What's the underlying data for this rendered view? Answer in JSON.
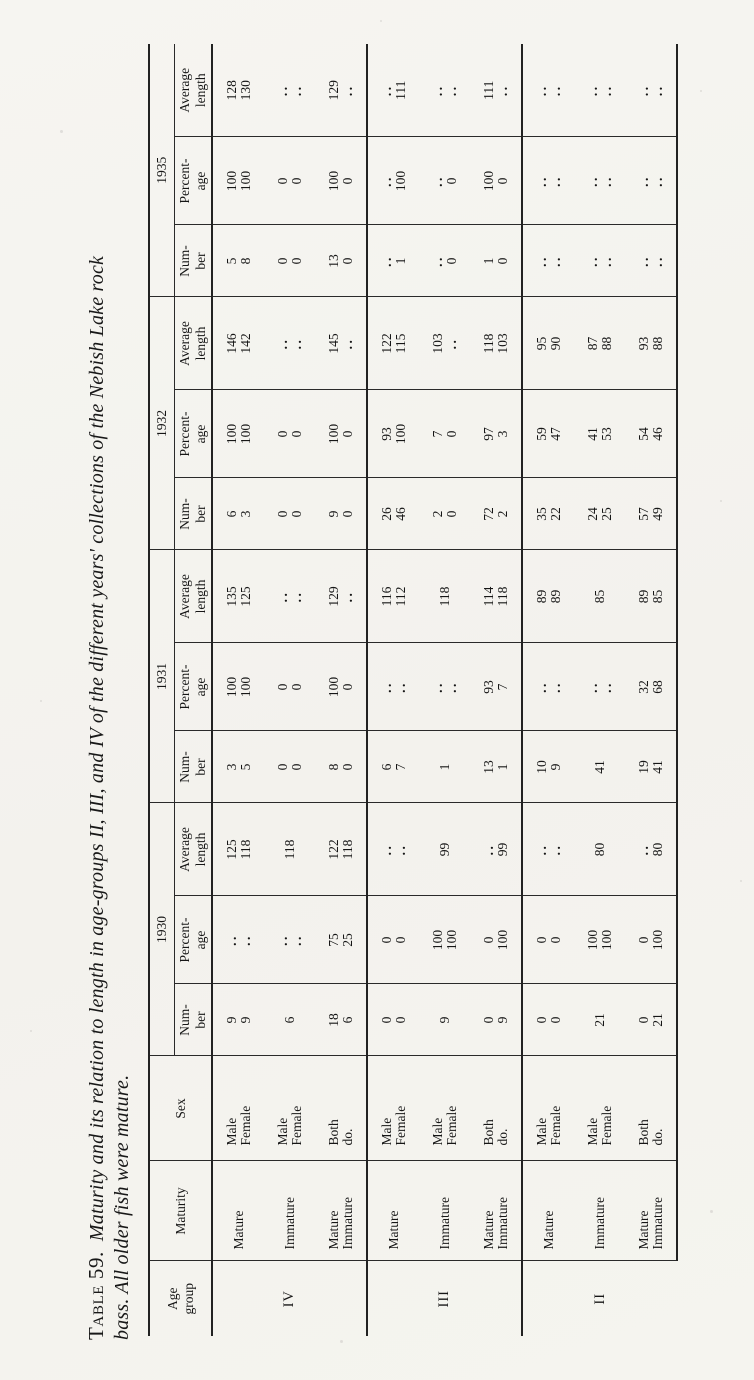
{
  "title": {
    "label": "Table 59.",
    "line1": "Maturity and its relation to length in age-groups II, III, and IV of the different years' collections of the Nebish Lake rock",
    "line2": "bass.  All older fish were mature."
  },
  "table": {
    "headers": {
      "age_group": [
        "Age",
        "group"
      ],
      "maturity": [
        "Maturity"
      ],
      "sex": [
        "Sex"
      ],
      "years": [
        "1930",
        "1931",
        "1932",
        "1935"
      ],
      "year_sub": [
        [
          "Num-",
          "ber"
        ],
        [
          "Percent-",
          "age"
        ],
        [
          "Average",
          "length"
        ]
      ]
    },
    "groups": [
      {
        "age": "IV",
        "blocks": [
          {
            "maturity": [
              "Mature"
            ],
            "sex": [
              "Male",
              "Female"
            ],
            "years": [
              {
                "n": [
                  "9",
                  "9"
                ],
                "p": [
                  "..",
                  ".."
                ],
                "a": [
                  "125",
                  "118"
                ]
              },
              {
                "n": [
                  "3",
                  "5"
                ],
                "p": [
                  "100",
                  "100"
                ],
                "a": [
                  "135",
                  "125"
                ]
              },
              {
                "n": [
                  "6",
                  "3"
                ],
                "p": [
                  "100",
                  "100"
                ],
                "a": [
                  "146",
                  "142"
                ]
              },
              {
                "n": [
                  "5",
                  "8"
                ],
                "p": [
                  "100",
                  "100"
                ],
                "a": [
                  "128",
                  "130"
                ]
              }
            ]
          },
          {
            "maturity": [
              "Immature"
            ],
            "sex": [
              "Male",
              "Female"
            ],
            "years": [
              {
                "n": [
                  "6"
                ],
                "p": [
                  "..",
                  ".."
                ],
                "a": [
                  "118"
                ]
              },
              {
                "n": [
                  "0",
                  "0"
                ],
                "p": [
                  "0",
                  "0"
                ],
                "a": [
                  "..",
                  ".."
                ]
              },
              {
                "n": [
                  "0",
                  "0"
                ],
                "p": [
                  "0",
                  "0"
                ],
                "a": [
                  "..",
                  ".."
                ]
              },
              {
                "n": [
                  "0",
                  "0"
                ],
                "p": [
                  "0",
                  "0"
                ],
                "a": [
                  "..",
                  ".."
                ]
              }
            ]
          },
          {
            "maturity": [
              "Mature",
              "Immature"
            ],
            "sex": [
              "Both",
              "do."
            ],
            "years": [
              {
                "n": [
                  "18",
                  "6"
                ],
                "p": [
                  "75",
                  "25"
                ],
                "a": [
                  "122",
                  "118"
                ]
              },
              {
                "n": [
                  "8",
                  "0"
                ],
                "p": [
                  "100",
                  "0"
                ],
                "a": [
                  "129",
                  ".."
                ]
              },
              {
                "n": [
                  "9",
                  "0"
                ],
                "p": [
                  "100",
                  "0"
                ],
                "a": [
                  "145",
                  ".."
                ]
              },
              {
                "n": [
                  "13",
                  "0"
                ],
                "p": [
                  "100",
                  "0"
                ],
                "a": [
                  "129",
                  ".."
                ]
              }
            ]
          }
        ]
      },
      {
        "age": "III",
        "blocks": [
          {
            "maturity": [
              "Mature"
            ],
            "sex": [
              "Male",
              "Female"
            ],
            "years": [
              {
                "n": [
                  "0",
                  "0"
                ],
                "p": [
                  "0",
                  "0"
                ],
                "a": [
                  "..",
                  ".."
                ]
              },
              {
                "n": [
                  "6",
                  "7"
                ],
                "p": [
                  "..",
                  ".."
                ],
                "a": [
                  "116",
                  "112"
                ]
              },
              {
                "n": [
                  "26",
                  "46"
                ],
                "p": [
                  "93",
                  "100"
                ],
                "a": [
                  "122",
                  "115"
                ]
              },
              {
                "n": [
                  "..",
                  "1"
                ],
                "p": [
                  "..",
                  "100"
                ],
                "a": [
                  "..",
                  "111"
                ]
              }
            ]
          },
          {
            "maturity": [
              "Immature"
            ],
            "sex": [
              "Male",
              "Female"
            ],
            "years": [
              {
                "n": [
                  "9"
                ],
                "p": [
                  "100",
                  "100"
                ],
                "a": [
                  "99"
                ]
              },
              {
                "n": [
                  "1"
                ],
                "p": [
                  "..",
                  ".."
                ],
                "a": [
                  "118"
                ]
              },
              {
                "n": [
                  "2",
                  "0"
                ],
                "p": [
                  "7",
                  "0"
                ],
                "a": [
                  "103",
                  ".."
                ]
              },
              {
                "n": [
                  "..",
                  "0"
                ],
                "p": [
                  "..",
                  "0"
                ],
                "a": [
                  "..",
                  ".."
                ]
              }
            ]
          },
          {
            "maturity": [
              "Mature",
              "Immature"
            ],
            "sex": [
              "Both",
              "do."
            ],
            "years": [
              {
                "n": [
                  "0",
                  "9"
                ],
                "p": [
                  "0",
                  "100"
                ],
                "a": [
                  "..",
                  "99"
                ]
              },
              {
                "n": [
                  "13",
                  "1"
                ],
                "p": [
                  "93",
                  "7"
                ],
                "a": [
                  "114",
                  "118"
                ]
              },
              {
                "n": [
                  "72",
                  "2"
                ],
                "p": [
                  "97",
                  "3"
                ],
                "a": [
                  "118",
                  "103"
                ]
              },
              {
                "n": [
                  "1",
                  "0"
                ],
                "p": [
                  "100",
                  "0"
                ],
                "a": [
                  "111",
                  ".."
                ]
              }
            ]
          }
        ]
      },
      {
        "age": "II",
        "blocks": [
          {
            "maturity": [
              "Mature"
            ],
            "sex": [
              "Male",
              "Female"
            ],
            "years": [
              {
                "n": [
                  "0",
                  "0"
                ],
                "p": [
                  "0",
                  "0"
                ],
                "a": [
                  "..",
                  ".."
                ]
              },
              {
                "n": [
                  "10",
                  "9"
                ],
                "p": [
                  "..",
                  ".."
                ],
                "a": [
                  "89",
                  "89"
                ]
              },
              {
                "n": [
                  "35",
                  "22"
                ],
                "p": [
                  "59",
                  "47"
                ],
                "a": [
                  "95",
                  "90"
                ]
              },
              {
                "n": [
                  "..",
                  ".."
                ],
                "p": [
                  "..",
                  ".."
                ],
                "a": [
                  "..",
                  ".."
                ]
              }
            ]
          },
          {
            "maturity": [
              "Immature"
            ],
            "sex": [
              "Male",
              "Female"
            ],
            "years": [
              {
                "n": [
                  "21"
                ],
                "p": [
                  "100",
                  "100"
                ],
                "a": [
                  "80"
                ]
              },
              {
                "n": [
                  "41"
                ],
                "p": [
                  "..",
                  ".."
                ],
                "a": [
                  "85"
                ]
              },
              {
                "n": [
                  "24",
                  "25"
                ],
                "p": [
                  "41",
                  "53"
                ],
                "a": [
                  "87",
                  "88"
                ]
              },
              {
                "n": [
                  "..",
                  ".."
                ],
                "p": [
                  "..",
                  ".."
                ],
                "a": [
                  "..",
                  ".."
                ]
              }
            ]
          },
          {
            "maturity": [
              "Mature",
              "Immature"
            ],
            "sex": [
              "Both",
              "do."
            ],
            "years": [
              {
                "n": [
                  "0",
                  "21"
                ],
                "p": [
                  "0",
                  "100"
                ],
                "a": [
                  "..",
                  "80"
                ]
              },
              {
                "n": [
                  "19",
                  "41"
                ],
                "p": [
                  "32",
                  "68"
                ],
                "a": [
                  "89",
                  "85"
                ]
              },
              {
                "n": [
                  "57",
                  "49"
                ],
                "p": [
                  "54",
                  "46"
                ],
                "a": [
                  "93",
                  "88"
                ]
              },
              {
                "n": [
                  "..",
                  ".."
                ],
                "p": [
                  "..",
                  ".."
                ],
                "a": [
                  "..",
                  ".."
                ]
              }
            ]
          }
        ]
      }
    ]
  }
}
